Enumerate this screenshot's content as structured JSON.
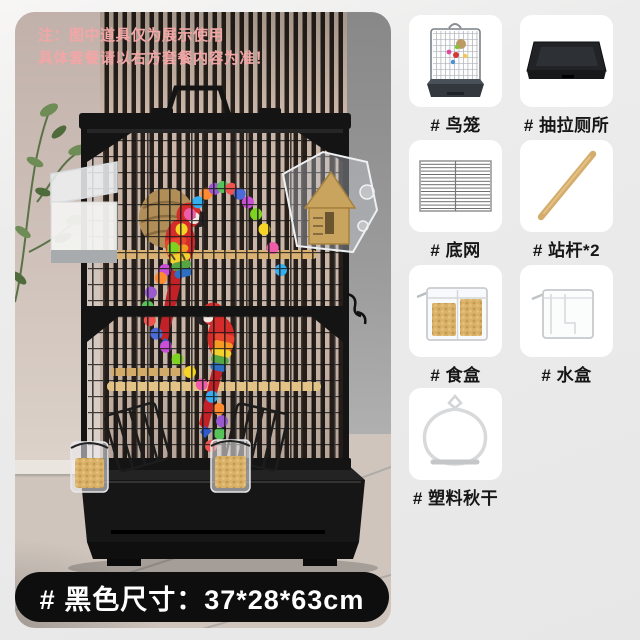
{
  "note": {
    "line1": "注：图中道具仅为展示使用",
    "line2": "具体套餐请以右方套餐内容为准！",
    "color": "#f2a6a6"
  },
  "size_bar": {
    "label": "# 黑色尺寸：37*28*63cm",
    "background": "#0e0e0e",
    "text_color": "#ffffff"
  },
  "package_items": [
    {
      "label": "# 鸟笼",
      "icon": "mini-birdcage-icon"
    },
    {
      "label": "# 抽拉厕所",
      "icon": "pull-out-tray-icon"
    },
    {
      "label": "# 底网",
      "icon": "bottom-grid-icon"
    },
    {
      "label": "# 站杆*2",
      "icon": "wooden-perch-icon"
    },
    {
      "label": "# 食盒",
      "icon": "food-box-icon"
    },
    {
      "label": "# 水盒",
      "icon": "water-box-icon"
    },
    {
      "label": "# 塑料秋干",
      "icon": "plastic-swing-icon"
    }
  ],
  "colors": {
    "page_background": "#ececec",
    "card_background": "#ffffff",
    "label_text": "#161616",
    "note_text": "#f2a6a6",
    "banner_background": "#0e0e0e",
    "banner_text": "#ffffff",
    "cage_wire": "#181818",
    "slat_light": "#c9b6a8",
    "slat_dark": "#261f1a",
    "wood_perch": "#d7b272",
    "parrot_red": "#d42b2b"
  }
}
